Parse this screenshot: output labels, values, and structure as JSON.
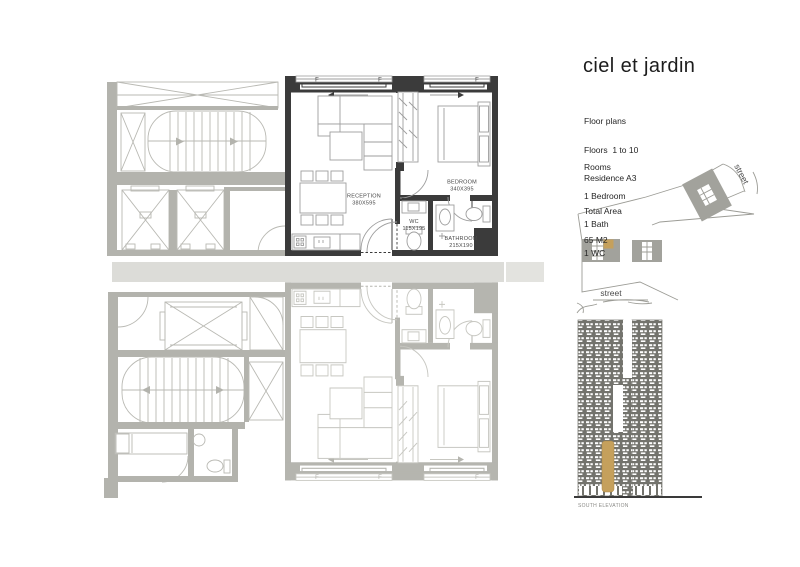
{
  "title": "ciel et jardin",
  "info": {
    "line1": "Floor plans",
    "line2": "Floors  1 to 10",
    "line3": "Residence A3"
  },
  "rooms": {
    "heading": "Rooms",
    "items": [
      "1 Bedroom",
      "1 Bath",
      "1 WC"
    ]
  },
  "total_area": {
    "heading": "Total Area",
    "value": "65 M2"
  },
  "unit": {
    "reception": {
      "name": "RECEPTION",
      "dims": "380X595"
    },
    "bedroom": {
      "name": "BEDROOM",
      "dims": "340X395"
    },
    "wc": {
      "name": "WC",
      "dims": "115X195"
    },
    "bathroom": {
      "name": "BATHROOM",
      "dims": "215X190"
    },
    "window_label": "F"
  },
  "site": {
    "street_right": "street",
    "street_bottom": "street"
  },
  "elevation": {
    "caption": "SOUTH ELEVATION"
  },
  "colors": {
    "highlight": "#3b3b3b",
    "plan_gray": "#b3b3ad",
    "accent_gold": "#c5a05c",
    "elevation_gray": "#73736d"
  }
}
